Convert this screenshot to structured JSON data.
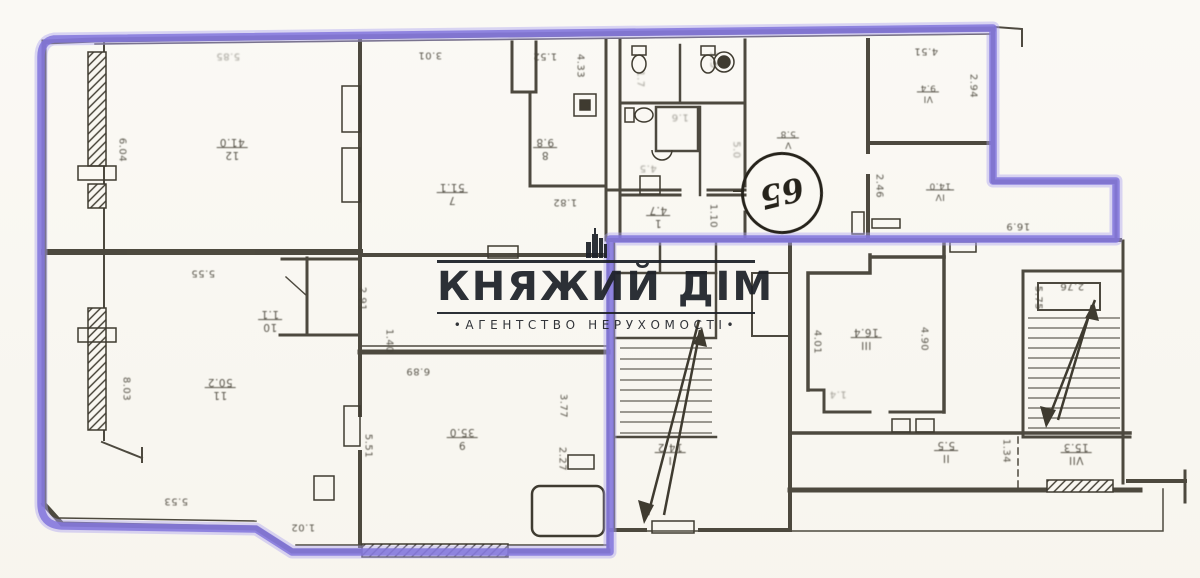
{
  "watermark": {
    "title": "КНЯЖИЙ ДІМ",
    "subtitle": "•АГЕНТСТВО НЕРУХОМОСТІ•",
    "icon": "building-icon"
  },
  "plan": {
    "circled_note": "65",
    "colors": {
      "highlight": "#8375dc",
      "wall": "#3f3b30",
      "paper": "#f9f7f1",
      "watermark": "#1d2128"
    },
    "rooms": [
      {
        "num": "12",
        "area": "41.0",
        "x": 232,
        "y": 148
      },
      {
        "num": "7",
        "area": "51.1",
        "x": 452,
        "y": 193
      },
      {
        "num": "8",
        "area": "9.8",
        "x": 545,
        "y": 148
      },
      {
        "num": "10",
        "area": "1.1",
        "x": 270,
        "y": 320
      },
      {
        "num": "11",
        "area": "50.2",
        "x": 220,
        "y": 388
      },
      {
        "num": "9",
        "area": "35.0",
        "x": 462,
        "y": 438
      },
      {
        "num": "1",
        "area": "4.7",
        "x": 658,
        "y": 216
      },
      {
        "num": "V",
        "area": "5.8",
        "x": 788,
        "y": 138,
        "small": true
      },
      {
        "num": "VI",
        "area": "9.4",
        "x": 928,
        "y": 92,
        "small": true
      },
      {
        "num": "IV",
        "area": "14.0",
        "x": 940,
        "y": 190,
        "small": true
      },
      {
        "num": "III",
        "area": "16.4",
        "x": 866,
        "y": 338
      },
      {
        "num": "I",
        "area": "14.2",
        "x": 670,
        "y": 453
      },
      {
        "num": "II",
        "area": "5.5",
        "x": 946,
        "y": 451
      },
      {
        "num": "VII",
        "area": "15.3",
        "x": 1076,
        "y": 453
      }
    ],
    "dims": [
      {
        "text": "5.85",
        "x": 228,
        "y": 56,
        "faint": true
      },
      {
        "text": "3.01",
        "x": 430,
        "y": 55
      },
      {
        "text": "1.52",
        "x": 545,
        "y": 56
      },
      {
        "text": "4.33",
        "x": 580,
        "y": 66,
        "v": true
      },
      {
        "text": "6.04",
        "x": 122,
        "y": 150,
        "v": true
      },
      {
        "text": "5.55",
        "x": 203,
        "y": 273
      },
      {
        "text": "2.91",
        "x": 362,
        "y": 299,
        "v": true
      },
      {
        "text": "1.40",
        "x": 389,
        "y": 341,
        "v": true
      },
      {
        "text": "8.03",
        "x": 126,
        "y": 389,
        "v": true
      },
      {
        "text": "5.53",
        "x": 176,
        "y": 501
      },
      {
        "text": "1.02",
        "x": 303,
        "y": 527
      },
      {
        "text": "6.89",
        "x": 418,
        "y": 371
      },
      {
        "text": "5.51",
        "x": 368,
        "y": 446,
        "v": true
      },
      {
        "text": "3.77",
        "x": 563,
        "y": 406,
        "v": true
      },
      {
        "text": "2.27",
        "x": 562,
        "y": 459,
        "v": true
      },
      {
        "text": "1.82",
        "x": 565,
        "y": 202
      },
      {
        "text": "1.10",
        "x": 713,
        "y": 216,
        "v": true
      },
      {
        "text": "4.51",
        "x": 926,
        "y": 51
      },
      {
        "text": "2.94",
        "x": 973,
        "y": 86,
        "v": true
      },
      {
        "text": "2.46",
        "x": 879,
        "y": 186,
        "v": true
      },
      {
        "text": "16.9",
        "x": 1018,
        "y": 226
      },
      {
        "text": "4.01",
        "x": 817,
        "y": 342,
        "v": true
      },
      {
        "text": "4.90",
        "x": 924,
        "y": 339,
        "v": true
      },
      {
        "text": "1.4",
        "x": 838,
        "y": 394,
        "faint": true
      },
      {
        "text": "5.75",
        "x": 1038,
        "y": 298,
        "v": true
      },
      {
        "text": "2.76",
        "x": 1072,
        "y": 286
      },
      {
        "text": "1.34",
        "x": 1006,
        "y": 451,
        "v": true
      },
      {
        "text": "1.7",
        "x": 640,
        "y": 79,
        "v": true,
        "faint": true
      },
      {
        "text": "1.5",
        "x": 713,
        "y": 60,
        "v": true,
        "faint": true
      },
      {
        "text": "1.6",
        "x": 680,
        "y": 117,
        "faint": true
      },
      {
        "text": "4.5",
        "x": 648,
        "y": 168,
        "faint": true
      },
      {
        "text": "5.0",
        "x": 736,
        "y": 150,
        "v": true,
        "faint": true
      }
    ]
  }
}
